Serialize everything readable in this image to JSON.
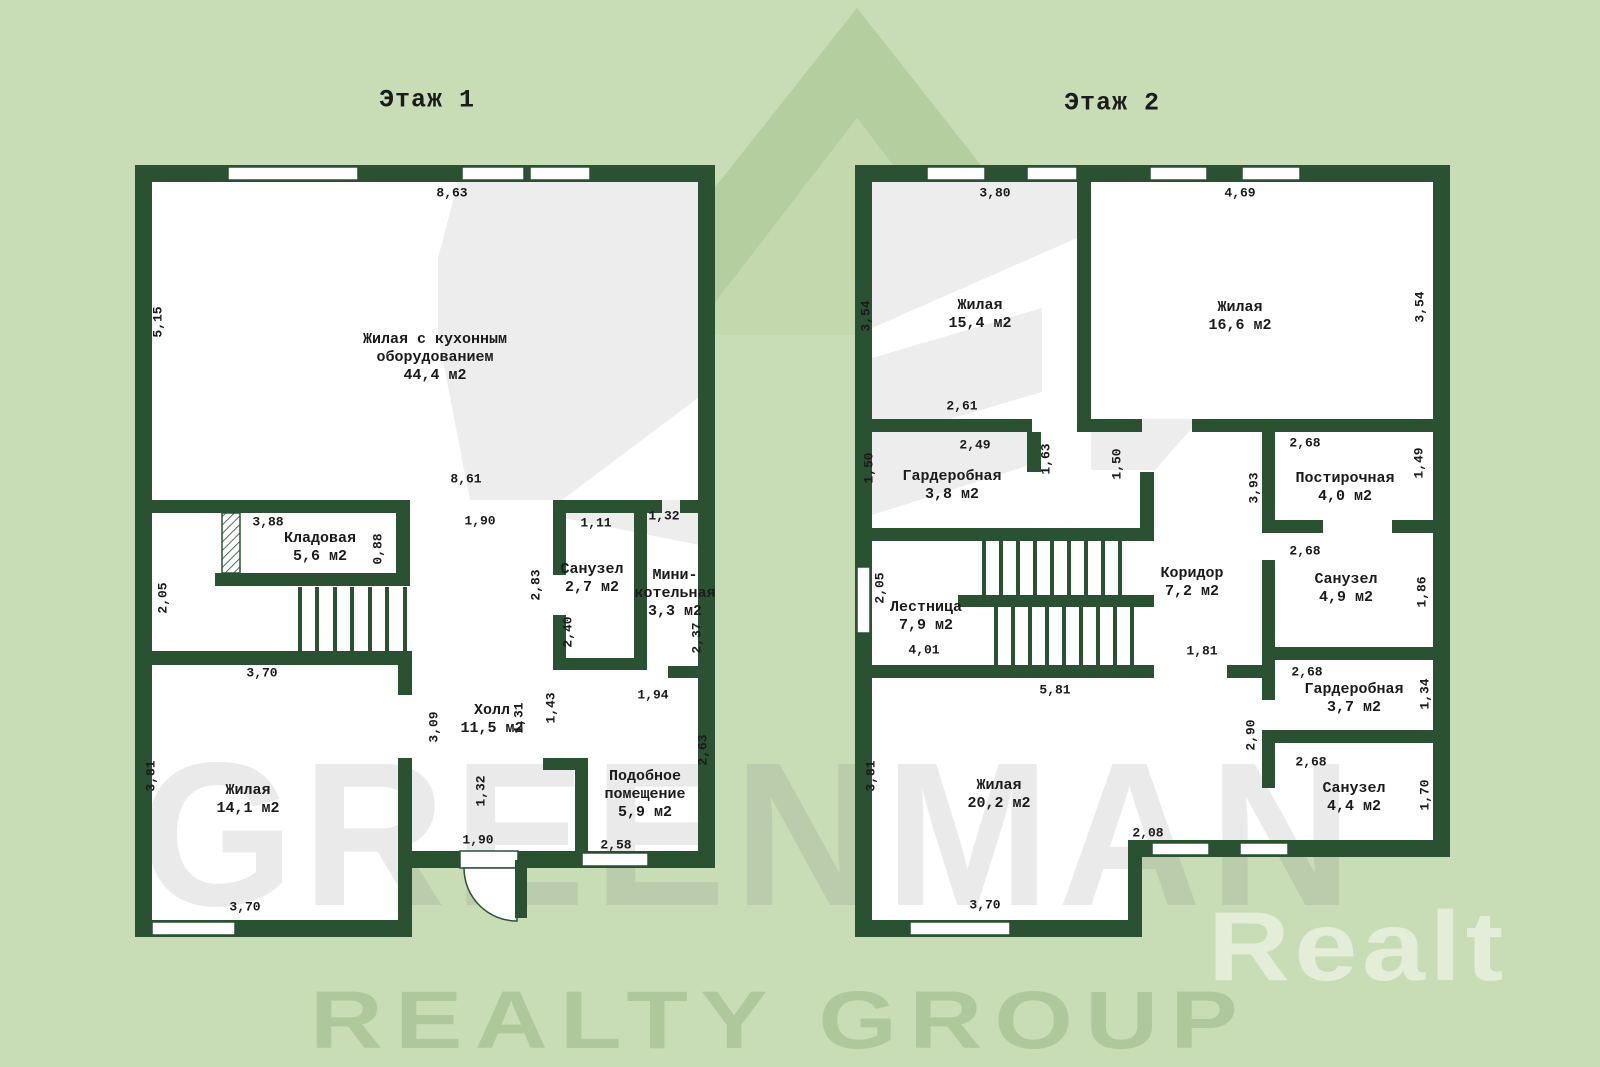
{
  "page": {
    "background_color": "#c8dcb6",
    "wall_color": "#2b5133",
    "floor_color": "#ffffff",
    "watermark_gray": "#ededed",
    "logo_green_dark": "#b5cea0",
    "logo_green_inner": "#c3d8ad",
    "text_color": "#1b1b1b"
  },
  "watermarks": {
    "greenman": "GREENMAN",
    "realty_group": "REALTY GROUP",
    "realt": "Realt"
  },
  "floor1": {
    "title": "Этаж 1",
    "title_x": 427,
    "title_y": 100,
    "rooms": [
      {
        "lines": [
          "Жилая с кухонным",
          "оборудованием",
          "44,4 м2"
        ],
        "x": 435,
        "cy": 358
      },
      {
        "lines": [
          "Кладовая",
          "5,6 м2"
        ],
        "x": 320,
        "cy": 548
      },
      {
        "lines": [
          "Санузел",
          "2,7 м2"
        ],
        "x": 592,
        "cy": 579
      },
      {
        "lines": [
          "Мини-",
          "котельная",
          "3,3 м2"
        ],
        "x": 675,
        "cy": 594
      },
      {
        "lines": [
          "Холл",
          "11,5 м2"
        ],
        "x": 492,
        "cy": 720
      },
      {
        "lines": [
          "Жилая",
          "14,1 м2"
        ],
        "x": 248,
        "cy": 800
      },
      {
        "lines": [
          "Подобное",
          "помещение",
          "5,9 м2"
        ],
        "x": 645,
        "cy": 795
      }
    ],
    "dimensions": [
      {
        "t": "8,63",
        "x": 452,
        "y": 193
      },
      {
        "t": "5,15",
        "x": 158,
        "y": 322,
        "r": 1
      },
      {
        "t": "8,61",
        "x": 466,
        "y": 479
      },
      {
        "t": "1,90",
        "x": 480,
        "y": 521
      },
      {
        "t": "3,88",
        "x": 268,
        "y": 522
      },
      {
        "t": "0,88",
        "x": 378,
        "y": 549,
        "r": 1
      },
      {
        "t": "1,11",
        "x": 596,
        "y": 523
      },
      {
        "t": "1,32",
        "x": 664,
        "y": 516
      },
      {
        "t": "2,05",
        "x": 163,
        "y": 598,
        "r": 1
      },
      {
        "t": "2,83",
        "x": 536,
        "y": 585,
        "r": 1
      },
      {
        "t": "2,40",
        "x": 568,
        "y": 632,
        "r": 1
      },
      {
        "t": "2,37",
        "x": 697,
        "y": 638,
        "r": 1
      },
      {
        "t": "3,70",
        "x": 262,
        "y": 673
      },
      {
        "t": "1,94",
        "x": 653,
        "y": 695
      },
      {
        "t": "3,09",
        "x": 434,
        "y": 727,
        "r": 1
      },
      {
        "t": "1,31",
        "x": 519,
        "y": 718,
        "r": 1
      },
      {
        "t": "1,43",
        "x": 551,
        "y": 708,
        "r": 1
      },
      {
        "t": "2,63",
        "x": 703,
        "y": 750,
        "r": 1
      },
      {
        "t": "3,81",
        "x": 151,
        "y": 776,
        "r": 1
      },
      {
        "t": "1,32",
        "x": 481,
        "y": 791,
        "r": 1
      },
      {
        "t": "1,90",
        "x": 478,
        "y": 840
      },
      {
        "t": "2,58",
        "x": 616,
        "y": 845
      },
      {
        "t": "3,70",
        "x": 245,
        "y": 907
      }
    ]
  },
  "floor2": {
    "title": "Этаж 2",
    "title_x": 1112,
    "title_y": 103,
    "rooms": [
      {
        "lines": [
          "Жилая",
          "15,4 м2"
        ],
        "x": 980,
        "cy": 315
      },
      {
        "lines": [
          "Жилая",
          "16,6 м2"
        ],
        "x": 1240,
        "cy": 317
      },
      {
        "lines": [
          "Гардеробная",
          "3,8 м2"
        ],
        "x": 952,
        "cy": 486
      },
      {
        "lines": [
          "Постирочная",
          "4,0 м2"
        ],
        "x": 1345,
        "cy": 488
      },
      {
        "lines": [
          "Коридор",
          "7,2 м2"
        ],
        "x": 1192,
        "cy": 583
      },
      {
        "lines": [
          "Санузел",
          "4,9 м2"
        ],
        "x": 1346,
        "cy": 589
      },
      {
        "lines": [
          "Лестница",
          "7,9 м2"
        ],
        "x": 926,
        "cy": 617
      },
      {
        "lines": [
          "Гардеробная",
          "3,7 м2"
        ],
        "x": 1354,
        "cy": 699
      },
      {
        "lines": [
          "Жилая",
          "20,2 м2"
        ],
        "x": 999,
        "cy": 795
      },
      {
        "lines": [
          "Санузел",
          "4,4 м2"
        ],
        "x": 1354,
        "cy": 798
      }
    ],
    "dimensions": [
      {
        "t": "3,80",
        "x": 995,
        "y": 193
      },
      {
        "t": "4,69",
        "x": 1240,
        "y": 193
      },
      {
        "t": "3,54",
        "x": 866,
        "y": 316,
        "r": 1
      },
      {
        "t": "3,54",
        "x": 1420,
        "y": 307,
        "r": 1
      },
      {
        "t": "2,61",
        "x": 962,
        "y": 406
      },
      {
        "t": "2,49",
        "x": 975,
        "y": 445
      },
      {
        "t": "1,50",
        "x": 869,
        "y": 468,
        "r": 1
      },
      {
        "t": "1,63",
        "x": 1046,
        "y": 459,
        "r": 1
      },
      {
        "t": "1,50",
        "x": 1117,
        "y": 464,
        "r": 1
      },
      {
        "t": "3,93",
        "x": 1254,
        "y": 488,
        "r": 1
      },
      {
        "t": "2,68",
        "x": 1305,
        "y": 443
      },
      {
        "t": "1,49",
        "x": 1419,
        "y": 463,
        "r": 1
      },
      {
        "t": "2,68",
        "x": 1305,
        "y": 551
      },
      {
        "t": "1,86",
        "x": 1422,
        "y": 592,
        "r": 1
      },
      {
        "t": "2,05",
        "x": 880,
        "y": 588,
        "r": 1
      },
      {
        "t": "4,01",
        "x": 924,
        "y": 650
      },
      {
        "t": "1,81",
        "x": 1202,
        "y": 651
      },
      {
        "t": "5,81",
        "x": 1055,
        "y": 690
      },
      {
        "t": "2,68",
        "x": 1307,
        "y": 672
      },
      {
        "t": "1,34",
        "x": 1425,
        "y": 694,
        "r": 1
      },
      {
        "t": "2,90",
        "x": 1251,
        "y": 735,
        "r": 1
      },
      {
        "t": "3,81",
        "x": 871,
        "y": 776,
        "r": 1
      },
      {
        "t": "2,68",
        "x": 1311,
        "y": 762
      },
      {
        "t": "1,70",
        "x": 1425,
        "y": 795,
        "r": 1
      },
      {
        "t": "2,08",
        "x": 1148,
        "y": 833
      },
      {
        "t": "3,70",
        "x": 985,
        "y": 905
      }
    ]
  }
}
